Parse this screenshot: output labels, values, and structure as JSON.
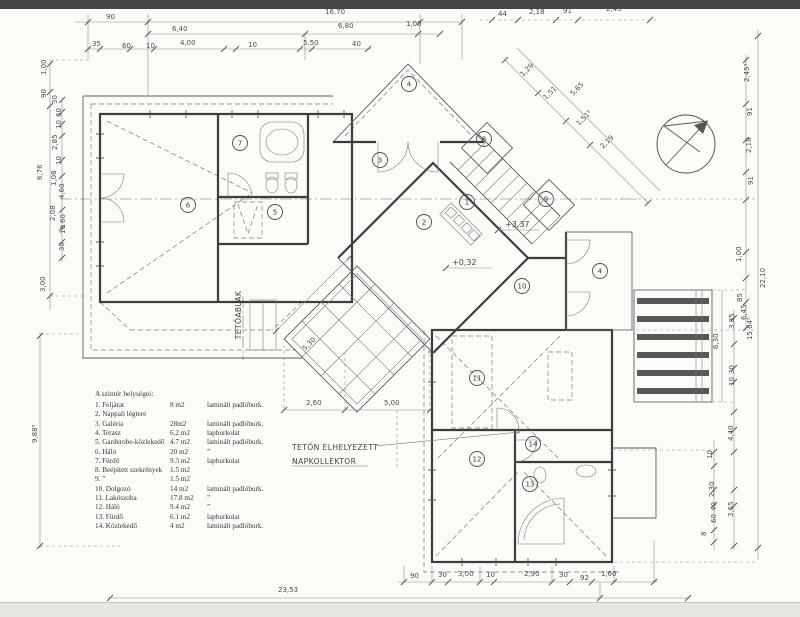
{
  "page": {
    "background": "#fbfbf8",
    "scan_bar_color": "#454545",
    "line_color": "#3d3d3d"
  },
  "legend": {
    "title": "A szintér helységei:",
    "rows": [
      {
        "name": "1.  Feljárat",
        "area": "8 m2",
        "floor": "laminált padlóburk."
      },
      {
        "name": "2.  Nappali légtere",
        "area": "",
        "floor": ""
      },
      {
        "name": "3.  Galéria",
        "area": "28m2",
        "floor": "laminált padlóburk."
      },
      {
        "name": "4.  Terasz",
        "area": "6.2 m2",
        "floor": "lapburkolat"
      },
      {
        "name": "5.  Garderobe-közlekedő",
        "area": "4.7 m2",
        "floor": "laminált padlóburk."
      },
      {
        "name": "6.  Háló",
        "area": "20 m2",
        "floor": "”"
      },
      {
        "name": "7.  Fürdő",
        "area": "9.3 m2",
        "floor": "lapburkolat"
      },
      {
        "name": "8.  Beépített szekrények",
        "area": "1.5 m2",
        "floor": ""
      },
      {
        "name": "9.  ”",
        "area": "1.5 m2",
        "floor": ""
      },
      {
        "name": "10. Dolgozó",
        "area": "14 m2",
        "floor": "laminált padlóburk."
      },
      {
        "name": "11. Lakószoba",
        "area": "17.8 m2",
        "floor": "”"
      },
      {
        "name": "12. Háló",
        "area": "9.4 m2",
        "floor": "”"
      },
      {
        "name": "13. Fürdő",
        "area": "6.1 m2",
        "floor": "lapburkolat"
      },
      {
        "name": "14. Közlekedő",
        "area": "4 m2",
        "floor": "laminált padlóburk."
      }
    ]
  },
  "rooms": [
    "1",
    "2",
    "3",
    "4",
    "4",
    "5",
    "6",
    "7",
    "8",
    "9",
    "10",
    "11",
    "12",
    "13",
    "14"
  ],
  "levels": {
    "upper": "+3,37",
    "entry": "+0,32"
  },
  "labels": {
    "skylight": "TETŐABLAK",
    "collector_line1": "TETŐN ELHELYEZETT",
    "collector_line2": "NAPKOLLEKTOR"
  },
  "dims": {
    "top": [
      "90",
      "16,70",
      "6,40",
      "6,80",
      "1,00",
      "35",
      "60",
      "10",
      "4,00",
      "10",
      "5,50",
      "40",
      "44",
      "2,18",
      "91",
      "2,45⁵"
    ],
    "diag": [
      "1,29",
      "1,51",
      "5,65",
      "1,51⁵",
      "2,19"
    ],
    "right": [
      "2,45⁵",
      "91",
      "2,18",
      "91",
      "1,00",
      "22,10",
      "85",
      "6,45",
      "3,85",
      "15,64⁵",
      "30",
      "10",
      "6,30",
      "4,40",
      "10",
      "2,30",
      "40",
      "60",
      "3,65",
      "8"
    ],
    "left": [
      "1,00",
      "90",
      "30",
      "60",
      "10",
      "2,85",
      "10",
      "1,08",
      "4,60",
      "6,76",
      "2,08",
      "60",
      "10",
      "30",
      "3,00",
      "9,88⁵"
    ],
    "bottom": [
      "23,53",
      "90",
      "30",
      "3,00",
      "10",
      "2,90",
      "30",
      "92",
      "1,60"
    ],
    "inner": [
      "5,30",
      "2,60",
      "5,00"
    ]
  }
}
